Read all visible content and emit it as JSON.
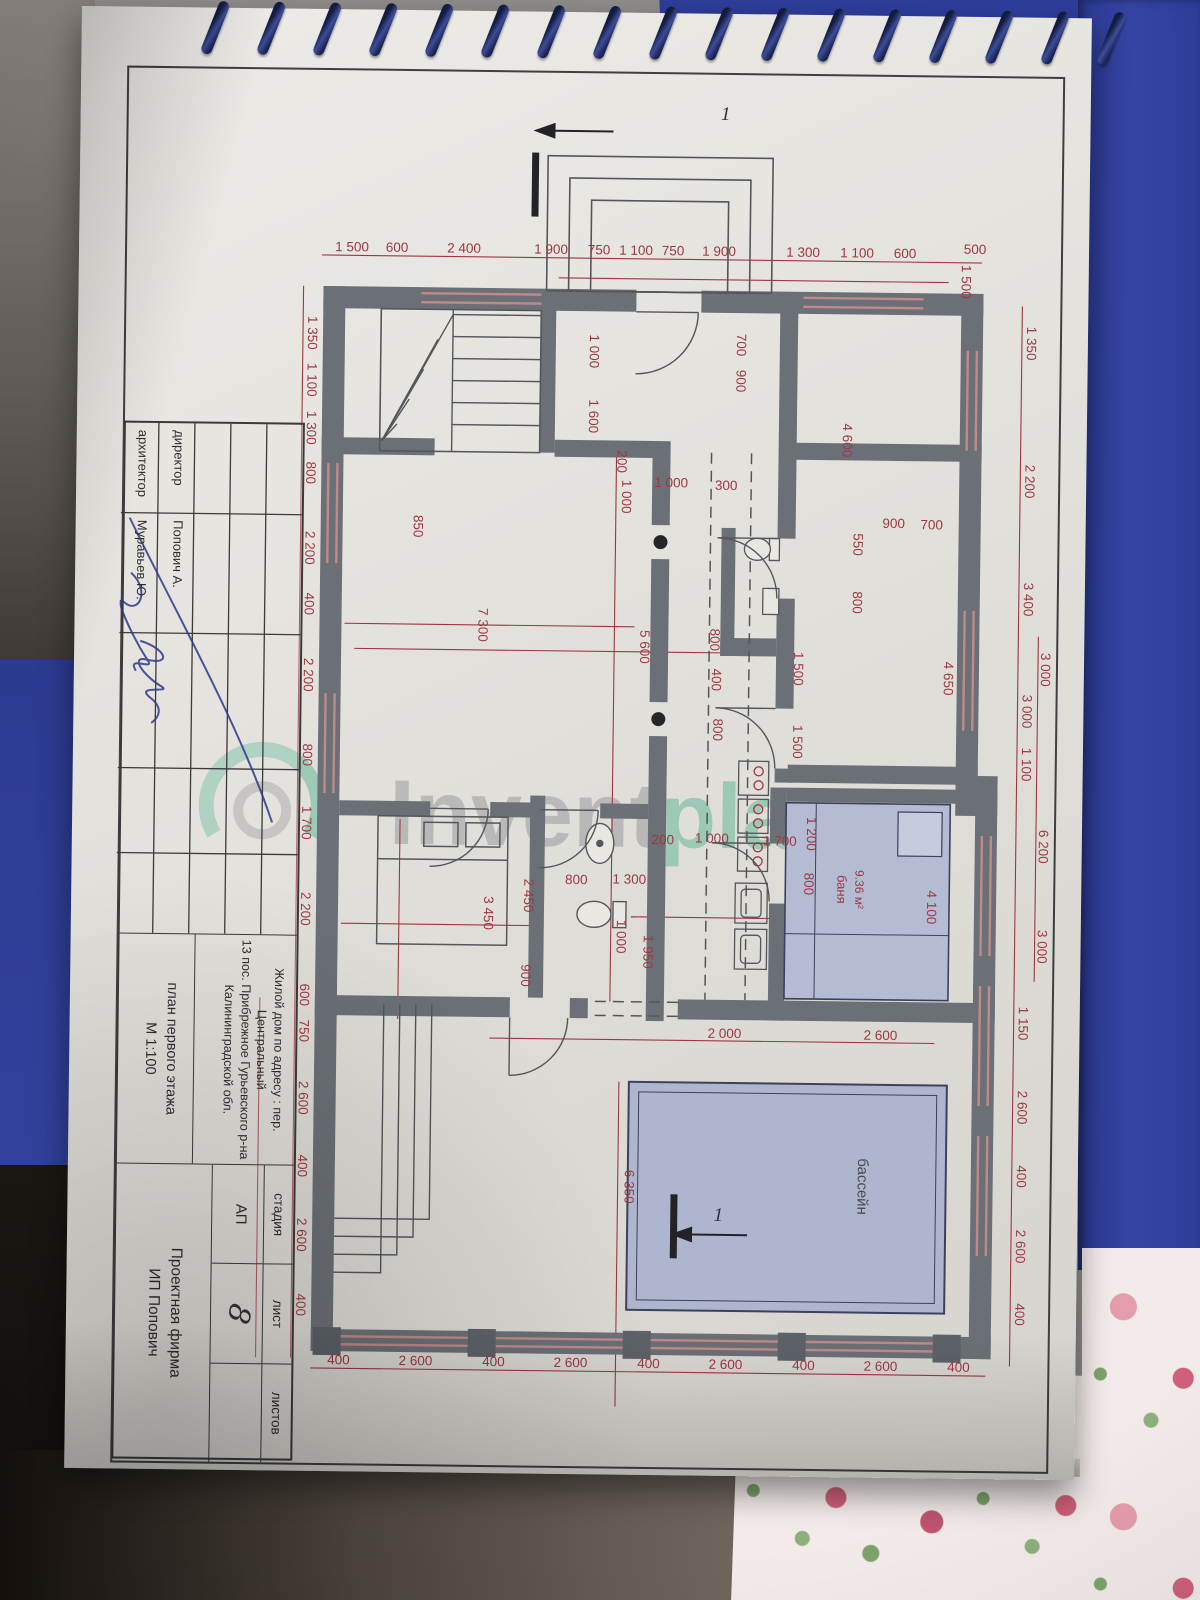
{
  "colors": {
    "dimension_red": "#9e3742",
    "wall_gray": "#6b7076",
    "pool_fill": "#aeb5ce",
    "bath_fill": "#b5bbd2",
    "watermark_green": "#3fae85",
    "watermark_gray": "#85868c",
    "folder_blue": "#2e3d9a",
    "ink_blue": "#2c3a8a"
  },
  "watermark": {
    "gray_text": "Invent",
    "green_text": "place"
  },
  "title_block": {
    "rows": [
      {
        "label": "директор",
        "value": "Попович А."
      },
      {
        "label": "архитектор",
        "value": "Муравьев Ю."
      }
    ],
    "address_lines": [
      "Жилой дом  по адресу : пер. Центральный",
      "13 пос. Прибрежное Гурьевского р-на",
      "Калининградской обл."
    ],
    "plan_title": "план первого этажа",
    "scale": "М 1:100",
    "stage_header": "стадия",
    "stage_value": "АП",
    "sheet_header": "лист",
    "sheet_value": "8",
    "sheets_header": "листов",
    "sheets_value": "",
    "firm_line1": "Проектная фирма",
    "firm_line2": "ИП Попович"
  },
  "plan": {
    "section_marks": [
      {
        "label": "1",
        "x": 47,
        "y": 335,
        "r": -90
      },
      {
        "label": "1",
        "x": 1148,
        "y": 329,
        "r": -90
      }
    ],
    "room_labels": [
      {
        "t": "бассейн",
        "x": 1112,
        "y": 190,
        "s": 15,
        "c": "#4a4a52"
      },
      {
        "t": "9.36 м²",
        "x": 815,
        "y": 196,
        "s": 12,
        "c": "#9e3742"
      },
      {
        "t": "баня",
        "x": 815,
        "y": 214,
        "s": 13,
        "c": "#9e3742"
      }
    ],
    "dims": [
      {
        "t": "500",
        "x": 178,
        "y": 84,
        "r": -90
      },
      {
        "t": "1 500",
        "x": 206,
        "y": 97
      },
      {
        "t": "600",
        "x": 183,
        "y": 154,
        "r": -90
      },
      {
        "t": "1 100",
        "x": 183,
        "y": 202,
        "r": -90
      },
      {
        "t": "1 300",
        "x": 183,
        "y": 256,
        "r": -90
      },
      {
        "t": "1 900",
        "x": 183,
        "y": 340,
        "r": -90
      },
      {
        "t": "750",
        "x": 183,
        "y": 386,
        "r": -90
      },
      {
        "t": "1 100",
        "x": 183,
        "y": 423,
        "r": -90
      },
      {
        "t": "750",
        "x": 183,
        "y": 460,
        "r": -90
      },
      {
        "t": "1 900",
        "x": 183,
        "y": 508,
        "r": -90
      },
      {
        "t": "2 400",
        "x": 183,
        "y": 595,
        "r": -90
      },
      {
        "t": "600",
        "x": 183,
        "y": 662,
        "r": -90
      },
      {
        "t": "1 500",
        "x": 183,
        "y": 707,
        "r": -90
      },
      {
        "t": "1 350",
        "x": 265,
        "y": 750
      },
      {
        "t": "1 100",
        "x": 312,
        "y": 750
      },
      {
        "t": "1 300",
        "x": 360,
        "y": 750
      },
      {
        "t": "800",
        "x": 405,
        "y": 750
      },
      {
        "t": "2 200",
        "x": 480,
        "y": 750
      },
      {
        "t": "400",
        "x": 536,
        "y": 750
      },
      {
        "t": "2 200",
        "x": 607,
        "y": 750
      },
      {
        "t": "800",
        "x": 687,
        "y": 750
      },
      {
        "t": "1 700",
        "x": 755,
        "y": 750
      },
      {
        "t": "2 200",
        "x": 841,
        "y": 750
      },
      {
        "t": "600",
        "x": 927,
        "y": 750
      },
      {
        "t": "750",
        "x": 963,
        "y": 750
      },
      {
        "t": "2 600",
        "x": 1030,
        "y": 750
      },
      {
        "t": "400",
        "x": 1098,
        "y": 750
      },
      {
        "t": "2 600",
        "x": 1167,
        "y": 750
      },
      {
        "t": "400",
        "x": 1237,
        "y": 750
      },
      {
        "t": "1 350",
        "x": 267,
        "y": 31
      },
      {
        "t": "2 200",
        "x": 405,
        "y": 31
      },
      {
        "t": "3 400",
        "x": 523,
        "y": 31
      },
      {
        "t": "3 000",
        "x": 635,
        "y": 31
      },
      {
        "t": "1 100",
        "x": 688,
        "y": 31
      },
      {
        "t": "1 150",
        "x": 947,
        "y": 31
      },
      {
        "t": "2 600",
        "x": 1031,
        "y": 31
      },
      {
        "t": "400",
        "x": 1100,
        "y": 31
      },
      {
        "t": "2 600",
        "x": 1170,
        "y": 31
      },
      {
        "t": "400",
        "x": 1238,
        "y": 31
      },
      {
        "t": "3 000",
        "x": 593,
        "y": 13,
        "s": 11.5
      },
      {
        "t": "6 200",
        "x": 770,
        "y": 13,
        "s": 11.5
      },
      {
        "t": "3 000",
        "x": 870,
        "y": 13,
        "s": 11.5
      },
      {
        "t": "400",
        "x": 1296,
        "y": 87,
        "r": -90
      },
      {
        "t": "2 600",
        "x": 1296,
        "y": 165,
        "r": -90
      },
      {
        "t": "400",
        "x": 1296,
        "y": 242,
        "r": -90
      },
      {
        "t": "2 600",
        "x": 1296,
        "y": 320,
        "r": -90
      },
      {
        "t": "400",
        "x": 1296,
        "y": 397,
        "r": -90
      },
      {
        "t": "2 600",
        "x": 1296,
        "y": 475,
        "r": -90
      },
      {
        "t": "400",
        "x": 1296,
        "y": 552,
        "r": -90
      },
      {
        "t": "2 600",
        "x": 1296,
        "y": 630,
        "r": -90
      },
      {
        "t": "400",
        "x": 1296,
        "y": 707,
        "r": -90
      },
      {
        "t": "850",
        "x": 457,
        "y": 642
      },
      {
        "t": "200",
        "x": 390,
        "y": 439
      },
      {
        "t": "1 000",
        "x": 280,
        "y": 468
      },
      {
        "t": "1 600",
        "x": 345,
        "y": 468
      },
      {
        "t": "7 300",
        "x": 555,
        "y": 576
      },
      {
        "t": "5 600",
        "x": 575,
        "y": 414
      },
      {
        "t": "1 000",
        "x": 425,
        "y": 434
      },
      {
        "t": "1 000",
        "x": 865,
        "y": 434
      },
      {
        "t": "1 000",
        "x": 415,
        "y": 385,
        "r": -90
      },
      {
        "t": "300",
        "x": 417,
        "y": 330,
        "r": -90
      },
      {
        "t": "800",
        "x": 567,
        "y": 344
      },
      {
        "t": "400",
        "x": 607,
        "y": 342
      },
      {
        "t": "800",
        "x": 657,
        "y": 340
      },
      {
        "t": "550",
        "x": 470,
        "y": 202
      },
      {
        "t": "800",
        "x": 528,
        "y": 202
      },
      {
        "t": "900",
        "x": 453,
        "y": 162,
        "r": -90
      },
      {
        "t": "700",
        "x": 454,
        "y": 124,
        "r": -90
      },
      {
        "t": "4 650",
        "x": 603,
        "y": 110
      },
      {
        "t": "1 500",
        "x": 595,
        "y": 260
      },
      {
        "t": "1 500",
        "x": 668,
        "y": 260
      },
      {
        "t": "700",
        "x": 272,
        "y": 321
      },
      {
        "t": "900",
        "x": 308,
        "y": 321
      },
      {
        "t": "4 600",
        "x": 366,
        "y": 214
      },
      {
        "t": "1 700",
        "x": 772,
        "y": 272,
        "r": -90
      },
      {
        "t": "1 200",
        "x": 760,
        "y": 245
      },
      {
        "t": "800",
        "x": 810,
        "y": 247
      },
      {
        "t": "4 100",
        "x": 832,
        "y": 124
      },
      {
        "t": "200",
        "x": 772,
        "y": 389,
        "r": -90
      },
      {
        "t": "1 000",
        "x": 770,
        "y": 340,
        "r": -90
      },
      {
        "t": "800",
        "x": 813,
        "y": 475,
        "r": -90
      },
      {
        "t": "1 300",
        "x": 812,
        "y": 422,
        "r": -90
      },
      {
        "t": "1 950",
        "x": 880,
        "y": 407
      },
      {
        "t": "2 450",
        "x": 825,
        "y": 527
      },
      {
        "t": "3 450",
        "x": 843,
        "y": 567
      },
      {
        "t": "900",
        "x": 905,
        "y": 529
      },
      {
        "t": "2 000",
        "x": 965,
        "y": 325,
        "r": -90
      },
      {
        "t": "2 600",
        "x": 965,
        "y": 169,
        "r": -90
      },
      {
        "t": "6 350",
        "x": 1115,
        "y": 423
      }
    ]
  }
}
